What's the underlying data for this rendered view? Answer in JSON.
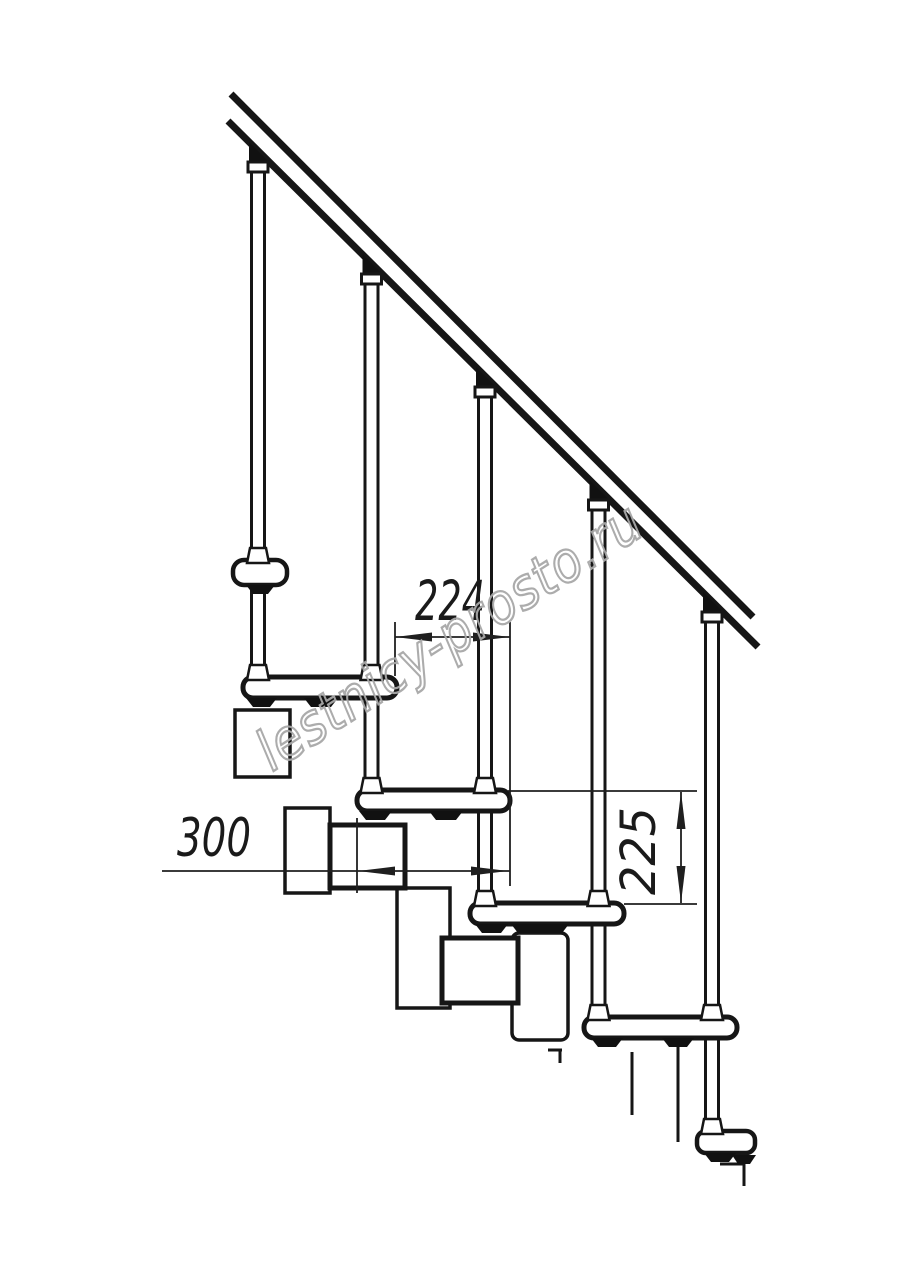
{
  "drawing": {
    "kind": "modular staircase side elevation",
    "watermark": {
      "text": "lestnicy-prosto.ru",
      "color": "#a8a8a8"
    },
    "dimensions": {
      "tread_run": {
        "value": "224"
      },
      "tread_depth": {
        "value": "300"
      },
      "step_rise": {
        "value": "225"
      }
    },
    "colors": {
      "background": "#ffffff",
      "line": "#161616",
      "dimension": "#1f1f1f"
    }
  }
}
